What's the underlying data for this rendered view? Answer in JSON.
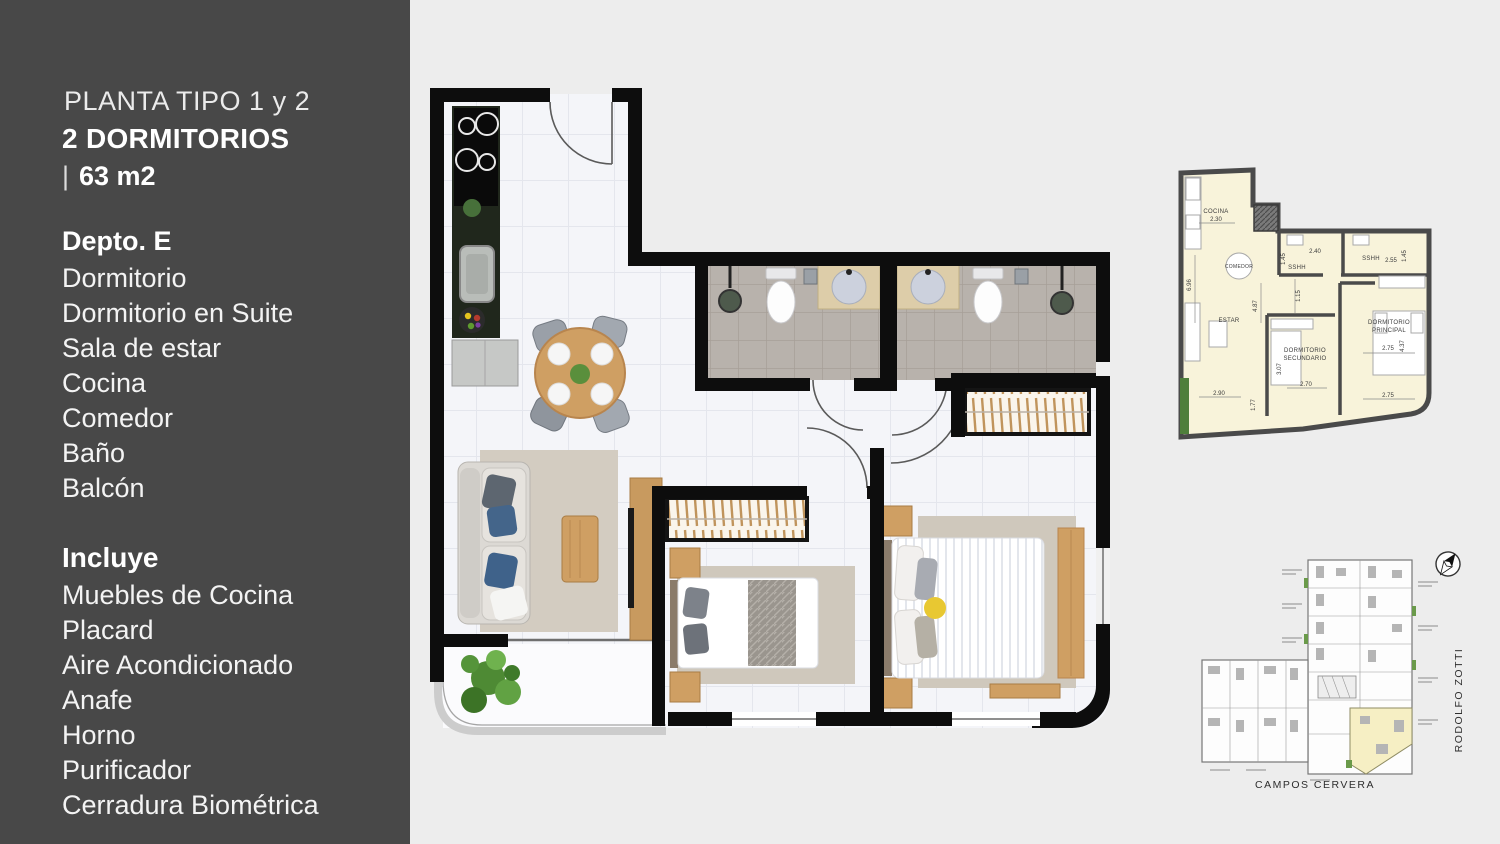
{
  "sidebar": {
    "plan_type": "PLANTA TIPO 1 y 2",
    "bedrooms": "2 DORMITORIOS",
    "area_prefix": "|",
    "area": "63 m2",
    "unit_title": "Depto. E",
    "rooms": [
      "Dormitorio",
      "Dormitorio en Suite",
      "Sala de estar",
      "Cocina",
      "Comedor",
      "Baño",
      "Balcón"
    ],
    "includes_title": "Incluye",
    "includes": [
      "Muebles de Cocina",
      "Placard",
      "Aire Acondicionado",
      "Anafe",
      "Horno",
      "Purificador",
      "Cerradura Biométrica"
    ]
  },
  "mini_plan": {
    "labels": {
      "cocina": "COCINA",
      "cocina_dim": "2.30",
      "comedor": "COMEDOR",
      "estar": "ESTAR",
      "sshh_left": "SSHH",
      "dim_240": "2.40",
      "sshh_right": "SSHH",
      "dim_255": "2.55",
      "dim_145_left": "1.45",
      "dim_145_right": "1.45",
      "dim_696": "6.96",
      "dim_487": "4.87",
      "dim_115": "1.15",
      "dorm_sec_line1": "DORMITORIO",
      "dorm_sec_line2": "SECUNDARIO",
      "dim_307": "3.07",
      "dim_270": "2.70",
      "dorm_ppal_line1": "DORMITORIO",
      "dorm_ppal_line2": "PRINCIPAL",
      "dim_275_top": "2.75",
      "dim_437": "4.37",
      "dim_275_bottom": "2.75",
      "dim_290": "2.90",
      "dim_177": "1.77"
    }
  },
  "site_plan": {
    "street_bottom": "CAMPOS CERVERA",
    "street_right": "RODOLFO ZOTTI"
  },
  "colors": {
    "sidebar_bg": "#484848",
    "page_bg": "#ededed",
    "plan_wall": "#0d0d0d",
    "mini_fill": "#f8f3da",
    "mini_wall": "#4a4a4a",
    "wood": "#cf9f63",
    "rug": "#d3ccc1",
    "bath_tile": "#b8b2ac",
    "unit_highlight": "#f6efc4"
  }
}
